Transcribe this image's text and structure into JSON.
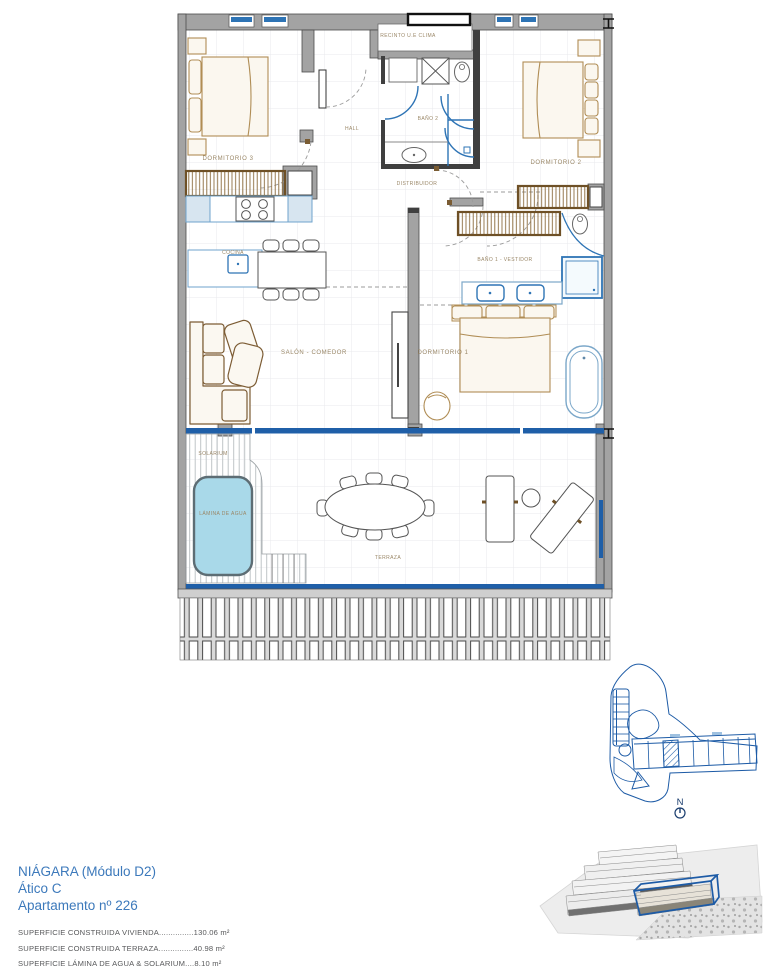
{
  "plan": {
    "rooms": {
      "recinto": "RECINTO U.E CLIMA",
      "hall": "HALL",
      "bano2": "BAÑO 2",
      "dormitorio3": "DORMITORIO 3",
      "dormitorio2": "DORMITORIO 2",
      "distribuidor": "DISTRIBUIDOR",
      "cocina": "COCINA",
      "bano1": "BAÑO 1 - VESTIDOR",
      "salon": "SALÓN - COMEDOR",
      "dormitorio1": "DORMITORIO 1",
      "solarium": "SOLARIUM",
      "lamina": "LÁMINA DE AGUA",
      "terraza": "TERRAZA"
    },
    "north_label": "N"
  },
  "footer": {
    "project": "NIÁGARA (Módulo D2)",
    "unit": "Ático C",
    "apartment": "Apartamento nº 226",
    "areas": [
      "SUPERFICIE CONSTRUIDA VIVIENDA...............130.06 m²",
      "SUPERFICIE CONSTRUIDA TERRAZA...............40.98 m²",
      "SUPERFICIE LÁMINA DE AGUA & SOLARIUM....8.10 m²"
    ],
    "total": "SUPERFICIE EXTERIOR TOTAL 49.08 m²"
  },
  "colors": {
    "glass_blue": "#1f5fa8",
    "fixture_blue": "#2e74b5",
    "site_blue": "#1d5ba6",
    "label_tan": "#9a8767",
    "pool_fill": "#a9d9e9",
    "title_blue": "#3c79bb",
    "wall_gray": "#a3a3a3"
  }
}
